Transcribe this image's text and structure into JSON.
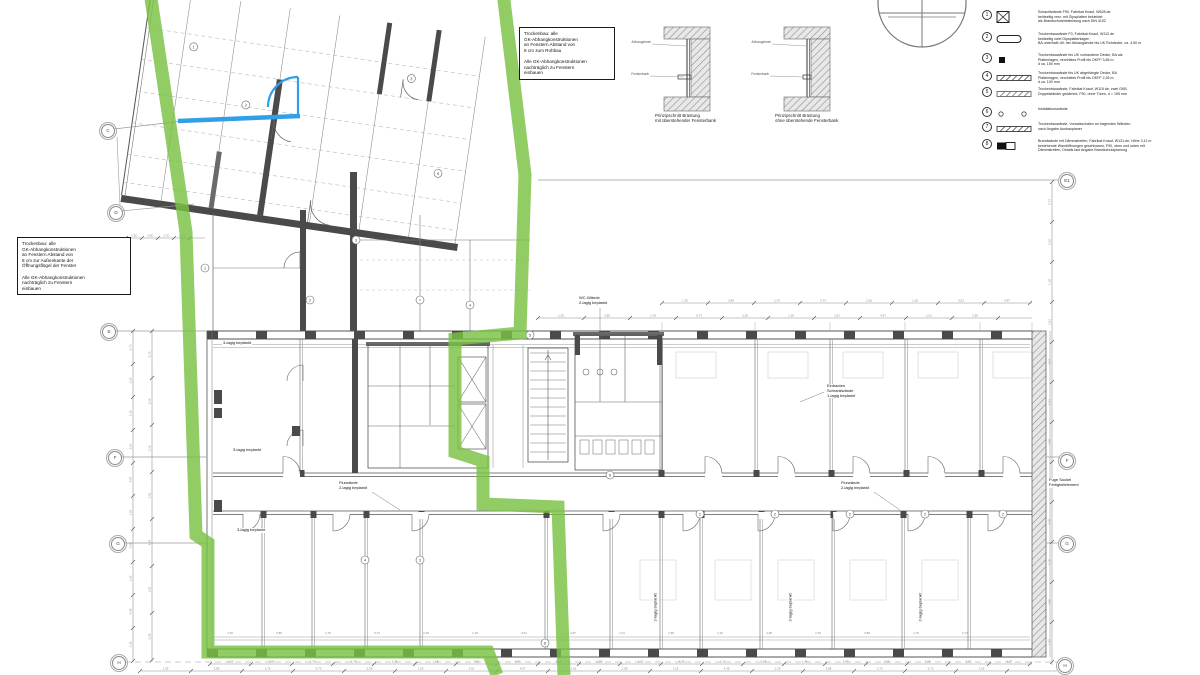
{
  "colors": {
    "boundary_green": "#7ac143",
    "markup_blue": "#2f9fe8",
    "wall_dark": "#4a4a4a",
    "line_gray": "#8a8a8a"
  },
  "notes": {
    "top_box": {
      "lines": [
        "Trockenbau: alle",
        "GK-Abhangkonstruktionen",
        "an Fenstern Abstand von",
        "8 cm zum Rohbau",
        "",
        "Alle GK-Abhangkonstruktionen",
        "nachträglich zu Fenstern",
        "einbauen"
      ]
    },
    "left_box": {
      "lines": [
        "Trockenbau: alle",
        "GK-Abhangkonstruktionen",
        "an Fenstern Abstand von",
        "8 cm zur Außenkante der",
        "Öffnungsflügel der Fenster",
        "",
        "Alle GK-Abhangkonstruktionen",
        "nachträglich zu Fenstern",
        "einbauen"
      ]
    }
  },
  "details": {
    "d1_caption": "Prinzipschnitt Brüstung\nmit überstehender Fensterbank",
    "d2_caption": "Prinzipschnitt Brüstung\nohne überstehende Fensterbank",
    "label_ceiling": "Abhangdecke",
    "label_sill": "Fensterbank"
  },
  "legend": {
    "items": [
      {
        "num": "1",
        "symbol": "crossed-box",
        "lines": [
          "Schachtwände F90, Fabrikat Knauf, W628.de",
          "beidseitig verz. mit Gipsplatten bekleidet",
          "als Brandschutzbekleidung nach DIN 4102"
        ]
      },
      {
        "num": "2",
        "symbol": "pill",
        "lines": [
          "Trockenbauwände F0, Fabrikat Knauf, W112.de",
          "beidseitig zwei Gipsplattenlagen",
          "BA unterhalb UK der Abhangdecke bis UK Rohdecke, ca. 4,50 m"
        ]
      },
      {
        "num": "3",
        "symbol": "filled-square",
        "lines": [
          "Trockenbauwände bis UK vorhandene Decke, BA als",
          "Plattenlagen, verzinktes Profil bis OKFF 3,85 m",
          "d ca. 150 mm"
        ]
      },
      {
        "num": "4",
        "symbol": "hatch-bar",
        "lines": [
          "Trockenbauwände bis UK abgehängte Decke, BA",
          "Plattenlagen, verzinktes Profil bis OKFF 2,26 m",
          "d ca. 100 mm"
        ]
      },
      {
        "num": "5",
        "symbol": "hatch-bar",
        "lines": [
          "Trockenbauwände, Fabrikat Knauf, W115.de, zwei GKB",
          "Doppelständer gedämmt, F90, ohne Türen, d = 155 mm"
        ]
      },
      {
        "num": "6",
        "symbol": "circles",
        "lines": [
          "Installationswände"
        ]
      },
      {
        "num": "7",
        "symbol": "hatch-bar",
        "lines": [
          "Trockenbauwände, Vorsatzschalen an tragenden Wänden",
          "nach Angabe Ausbauplaner"
        ]
      },
      {
        "num": "8",
        "symbol": "half-bar",
        "lines": [
          "Brandwände mit Dämmstreifen, Fabrikat Knauf, W131.de, Höhe 3,11 m",
          "bestehende Wandöffnungen geschlossen, F90, oben und unten mit",
          "Dämmstreifen, Details laut Angabe Brandschutzplanung"
        ]
      }
    ]
  },
  "grid_markers": {
    "left": [
      "C",
      "D",
      "E",
      "F",
      "G",
      "H"
    ],
    "right": [
      "E1",
      "F",
      "G",
      "H"
    ]
  },
  "plan_labels": [
    {
      "text": "WC-Wände\n2-lagig beplankt",
      "x": 578,
      "y": 296,
      "rot": 0
    },
    {
      "text": "Flurwände\n2-lagig beplankt",
      "x": 338,
      "y": 481,
      "rot": 0
    },
    {
      "text": "Flurwände\n2-lagig beplankt",
      "x": 840,
      "y": 481,
      "rot": 0
    },
    {
      "text": "3-lagig beplankt",
      "x": 222,
      "y": 341,
      "rot": 0
    },
    {
      "text": "3-lagig beplankt",
      "x": 232,
      "y": 448,
      "rot": 0
    },
    {
      "text": "3-lagig beplankt",
      "x": 236,
      "y": 528,
      "rot": 0
    },
    {
      "text": "Einbauten\nSchrankwände\n1-lagig beplankt",
      "x": 826,
      "y": 384,
      "rot": 0
    },
    {
      "text": "2-lagig beplankt",
      "x": 641,
      "y": 605,
      "rot": -90
    },
    {
      "text": "2-lagig beplankt",
      "x": 776,
      "y": 605,
      "rot": -90
    },
    {
      "text": "2-lagig beplankt",
      "x": 906,
      "y": 605,
      "rot": -90
    },
    {
      "text": "Fuge Sockel\nFertigteilelement",
      "x": 1048,
      "y": 478,
      "rot": 0
    }
  ],
  "micro_numbers": [
    "1,35",
    "3,85",
    "1,76",
    "5,73",
    "2,26",
    "1,18",
    "3,51",
    "4,97",
    "1,01",
    "2,58",
    "1,26",
    "4,38"
  ]
}
